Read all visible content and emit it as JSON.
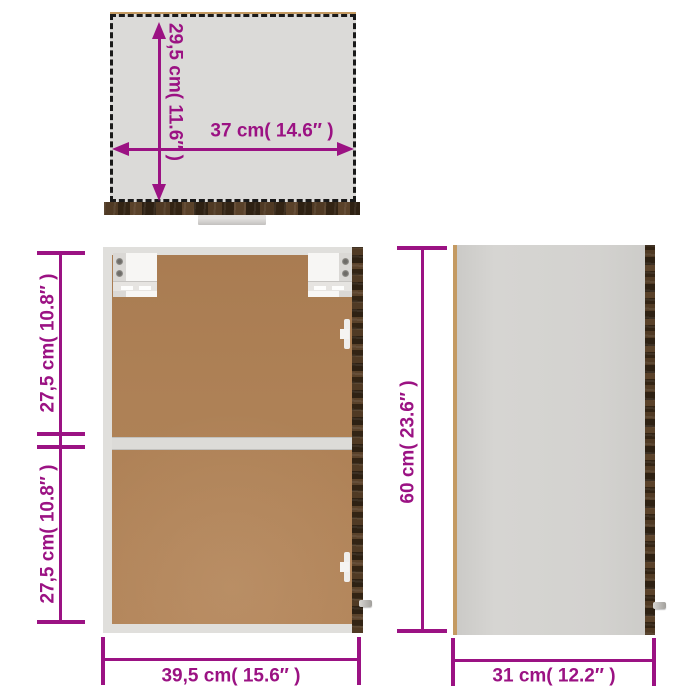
{
  "colors": {
    "dim": "#9B1283",
    "brown": "#AE8156",
    "frameGray": "#E0DFDC",
    "topGray": "#DBDAD8",
    "edgeTan": "#C49A62",
    "woodDark": "#3A2A19"
  },
  "top_view": {
    "depth_label": "29,5 cm( 11.6″ )",
    "width_label": "37 cm( 14.6″ )"
  },
  "front_view": {
    "upper_section_label": "27,5 cm( 10.8″ )",
    "lower_section_label": "27,5 cm( 10.8″ )",
    "width_label": "39,5 cm( 15.6″ )"
  },
  "side_view": {
    "height_label": "60 cm( 23.6″ )",
    "depth_label": "31 cm( 12.2″ )"
  }
}
